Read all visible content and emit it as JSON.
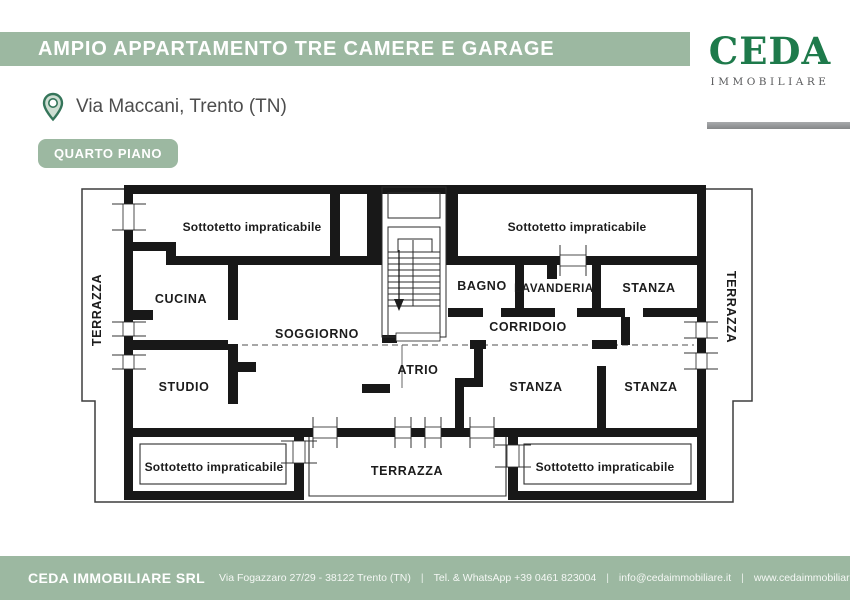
{
  "header": {
    "title": "AMPIO APPARTAMENTO TRE CAMERE E GARAGE",
    "location": "Via Maccani, Trento (TN)",
    "floor_badge": "QUARTO PIANO"
  },
  "logo": {
    "wordmark": "CEDA",
    "subtitle": "IMMOBILIARE"
  },
  "colors": {
    "sage_green": "#9cb8a1",
    "logo_green": "#1e7a4b",
    "wall_black": "#181818",
    "rule_gray": "#919396",
    "text_dark": "#4d4d4d"
  },
  "floorplan": {
    "labels": {
      "sottotetto": "Sottotetto impraticabile",
      "terrazza": "TERRAZZA",
      "cucina": "CUCINA",
      "soggiorno": "SOGGIORNO",
      "studio": "STUDIO",
      "bagno": "BAGNO",
      "lavanderia": "LAVANDERIA",
      "stanza": "STANZA",
      "corridoio": "CORRIDOIO",
      "atrio": "ATRIO"
    }
  },
  "footer": {
    "company": "CEDA IMMOBILIARE SRL",
    "separator": "|",
    "items": [
      "Via Fogazzaro 27/29 - 38122 Trento (TN)",
      "Tel. & WhatsApp +39 0461 823004",
      "info@cedaimmobiliare.it",
      "www.cedaimmobiliare.it"
    ]
  }
}
